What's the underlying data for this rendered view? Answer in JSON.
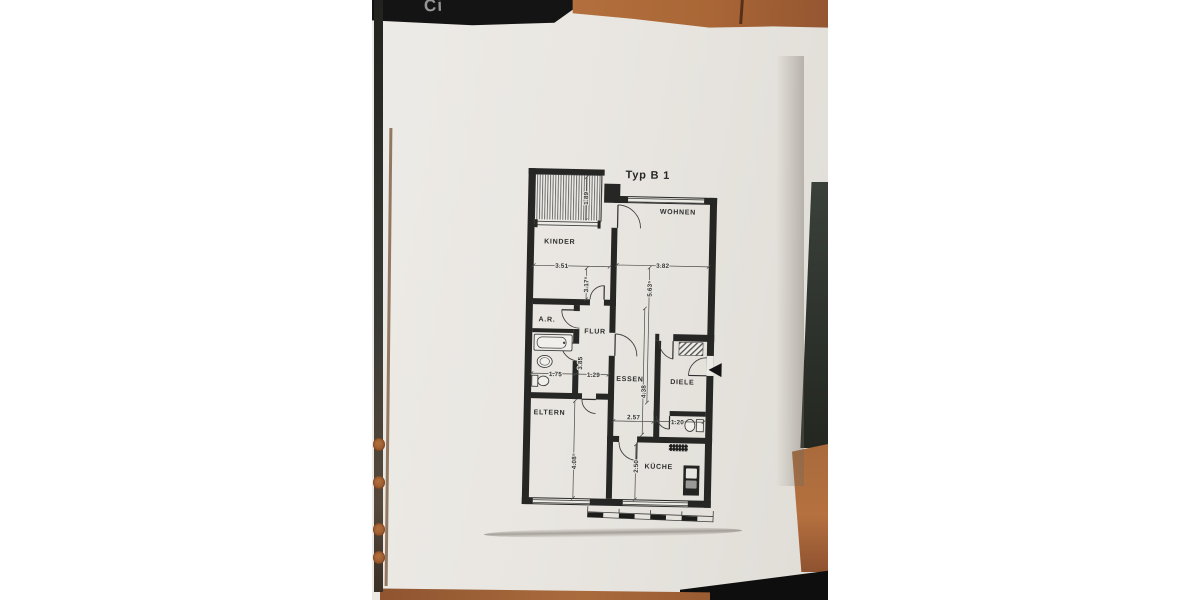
{
  "background": {
    "folder_partial_text": "Ci"
  },
  "plan": {
    "title": "Typ B 1",
    "rooms": {
      "wohnen": "WOHNEN",
      "kinder": "KINDER",
      "abstellraum": "A.R.",
      "flur": "FLUR",
      "essen": "ESSEN",
      "diele": "DIELE",
      "eltern": "ELTERN",
      "kueche": "KÜCHE"
    },
    "dims": {
      "balkon_tiefe": "1.89",
      "kinder_breite": "3.51",
      "wohnen_breite": "3.82",
      "kinder_tiefe": "3.17⁵",
      "wohnen_essen_tiefe": "5.63⁵",
      "bad_breite": "1.75",
      "flur_breite": "1.29",
      "bad_tiefe": "3.85",
      "essen_tiefe": "4.38",
      "essen_breite": "2.57",
      "wc_breite": "1.20",
      "eltern_tiefe": "4.08⁵",
      "kueche_tiefe": "2.50"
    }
  }
}
